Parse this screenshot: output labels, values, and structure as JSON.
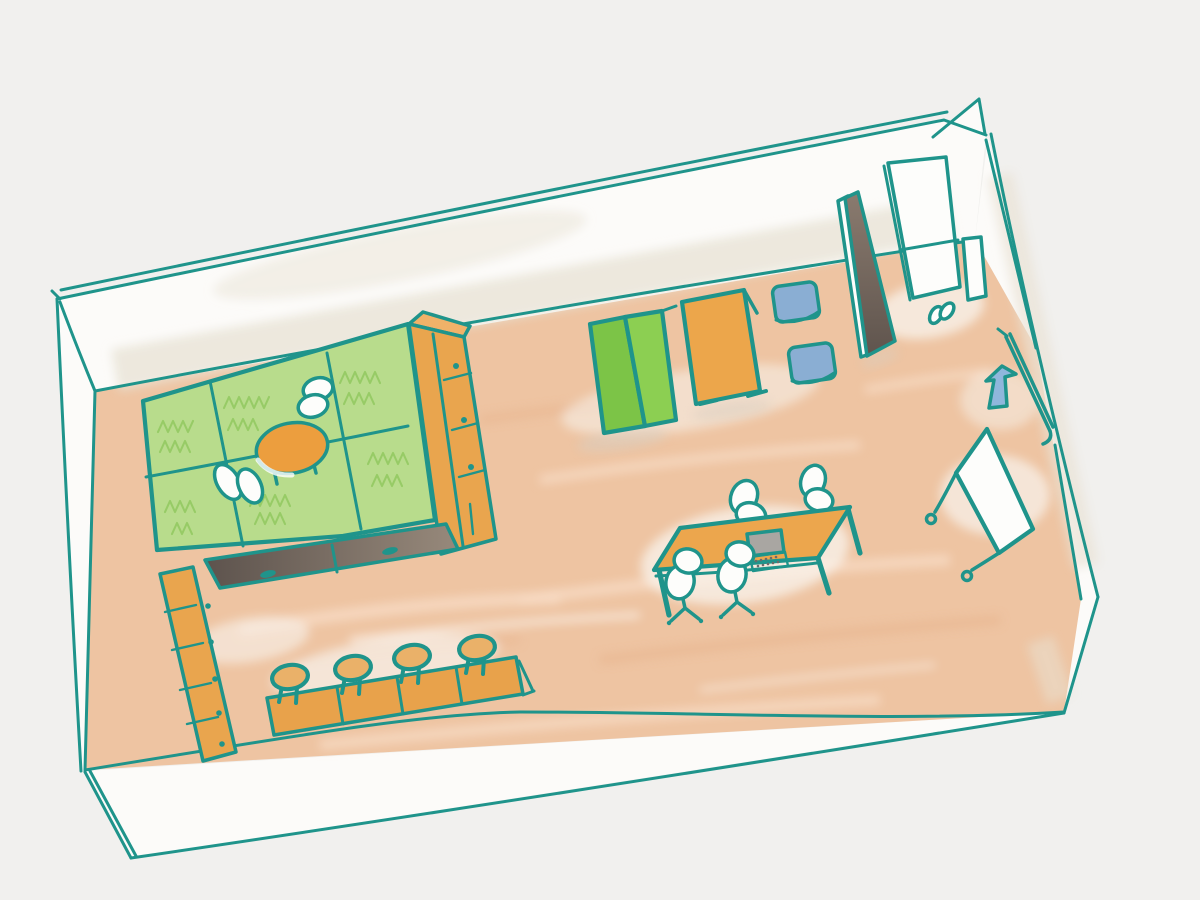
{
  "scene": {
    "description": "Hand-drawn watercolor sketch of a room layout in open-box perspective",
    "style": "marker and watercolor wash on paper",
    "text_content": "none"
  },
  "palette": {
    "paper": "#f1f0ee",
    "ink": "#1f948b",
    "wall_white": "#fcfbf9",
    "wall_wash": "#e9e3d6",
    "floor": "#eec4a2",
    "floor_streak_light": "#f8dcc5",
    "floor_streak_dark": "#e5ab83",
    "patch_white": "#f8f4ee",
    "shadow_tan": "#d9cec0",
    "tatami_green": "#b8dc8c",
    "tatami_scribble": "#8fc75c",
    "low_table_orange": "#ec9e3e",
    "cushion_white": "#fdfdfb",
    "wood_orange": "#e9a54e",
    "wood_orange_top": "#f0b269",
    "counter_orange": "#e8a24b",
    "stool_tan": "#eab169",
    "step_dark": "#5d534d",
    "step_light": "#97897b",
    "bifold_left": "#7cc447",
    "bifold_right": "#8ccf52",
    "board_orange": "#eca64b",
    "blue_cushion": "#8aaed3",
    "blue_arrow": "#8fb7dc",
    "panel_top": "#8a7b6f",
    "panel_bottom": "#5f544d",
    "white_item": "#fdfdfb",
    "laptop_screen": "#a9a6a2",
    "laptop_deck": "#e8e5e1",
    "key_dot": "#6b6b6b",
    "table_orange": "#eca64d"
  },
  "items": [
    {
      "id": "room-shell",
      "label": "room walls drawn as open box"
    },
    {
      "id": "floor",
      "label": "wooden floor with wash streaks"
    },
    {
      "id": "tatami-area",
      "label": "green tatami mat corner"
    },
    {
      "id": "low-table",
      "label": "low round table on tatami"
    },
    {
      "id": "floor-cushions-white",
      "label": "two white floor cushions"
    },
    {
      "id": "side-shelf",
      "label": "tall shelf beside tatami"
    },
    {
      "id": "left-shelf",
      "label": "low shelf along left wall"
    },
    {
      "id": "storage-step",
      "label": "dark storage step with two handles"
    },
    {
      "id": "counter",
      "label": "counter bar"
    },
    {
      "id": "stools",
      "label": "four round stools"
    },
    {
      "id": "folding-mat",
      "label": "green bi-fold mat standing"
    },
    {
      "id": "presentation-board",
      "label": "orange board on feet"
    },
    {
      "id": "floor-poufs-blue",
      "label": "two blue floor cushions"
    },
    {
      "id": "display-panel",
      "label": "dark display panel leaning"
    },
    {
      "id": "wall-whiteboard",
      "label": "white panels leaning on top wall"
    },
    {
      "id": "slippers",
      "label": "pair of slippers"
    },
    {
      "id": "entrance-door",
      "label": "door leaf in right wall"
    },
    {
      "id": "entrance-arrow",
      "label": "blue arrow marking entrance"
    },
    {
      "id": "mobile-whiteboard",
      "label": "whiteboard on caster wheels"
    },
    {
      "id": "meeting-table",
      "label": "meeting table"
    },
    {
      "id": "office-chairs",
      "label": "four white office chairs"
    },
    {
      "id": "laptop",
      "label": "laptop on table"
    }
  ]
}
